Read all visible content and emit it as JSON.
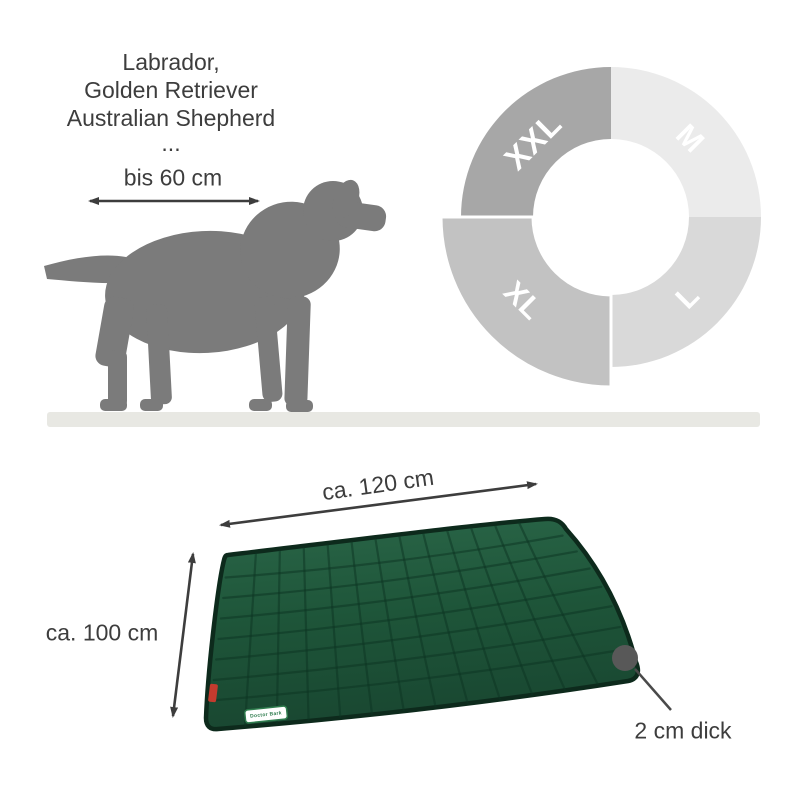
{
  "breeds": {
    "lines": [
      "Labrador,",
      "Golden Retriever",
      "Australian Shepherd",
      "..."
    ]
  },
  "dog": {
    "shoulder_width_label": "bis 60 cm",
    "silhouette_color": "#7b7b7b",
    "ground_color": "#e8e8e3"
  },
  "size_wheel": {
    "segments": [
      {
        "label": "XXL",
        "color": "#a7a7a7"
      },
      {
        "label": "M",
        "color": "#ebebeb"
      },
      {
        "label": "XL",
        "color": "#c2c2c2",
        "enlarged": true
      },
      {
        "label": "L",
        "color": "#d9d9d9"
      }
    ]
  },
  "mat": {
    "width_label": "ca. 120 cm",
    "height_label": "ca. 100 cm",
    "thickness_label": "2 cm dick",
    "brand_label": "Doctor Bark",
    "base_color": "#1e5539",
    "tag_color": "#c43b2e"
  },
  "annotation_color": "#3d3d3d"
}
